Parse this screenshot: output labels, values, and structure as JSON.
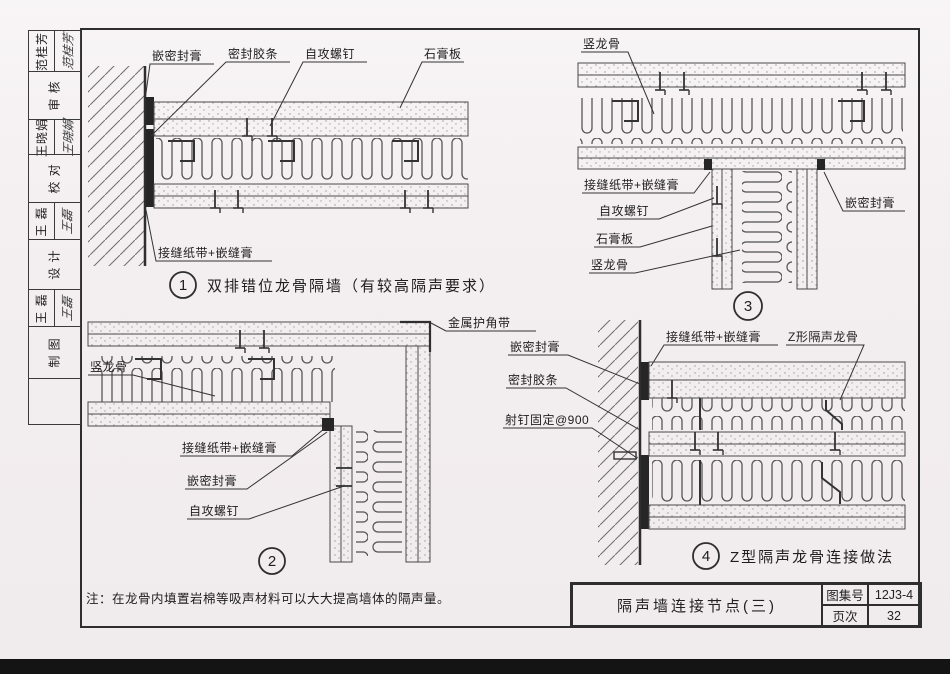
{
  "page": {
    "bg_color": "#f3eef0",
    "frame_color": "#2e2e2e",
    "line_color": "#3a3a3a"
  },
  "sidebar": {
    "groups": [
      {
        "role": "审 核",
        "name": "范桂芳",
        "signature": "范桂芳"
      },
      {
        "role": "校 对",
        "name": "王晓娟",
        "signature": "王晓娟"
      },
      {
        "role": "设 计",
        "name": "王 磊",
        "signature": "王磊"
      },
      {
        "role": "制 图",
        "name": "王 磊",
        "signature": "王磊"
      }
    ]
  },
  "drawings": {
    "d1": {
      "number": "1",
      "caption": "双排错位龙骨隔墙（有较高隔声要求）",
      "labels": {
        "seal": "嵌密封膏",
        "gasket": "密封胶条",
        "screw": "自攻螺钉",
        "board": "石膏板",
        "tape": "接缝纸带+嵌缝膏"
      }
    },
    "d2": {
      "number": "2",
      "labels": {
        "stud": "竖龙骨",
        "corner": "金属护角带",
        "tape": "接缝纸带+嵌缝膏",
        "seal": "嵌密封膏",
        "screw": "自攻螺钉"
      }
    },
    "d3": {
      "number": "3",
      "labels": {
        "stud_top": "竖龙骨",
        "tape": "接缝纸带+嵌缝膏",
        "screw": "自攻螺钉",
        "board": "石膏板",
        "stud": "竖龙骨",
        "seal": "嵌密封膏"
      }
    },
    "d4": {
      "number": "4",
      "caption": "Z型隔声龙骨连接做法",
      "labels": {
        "seal": "嵌密封膏",
        "gasket": "密封胶条",
        "nail": "射钉固定@900",
        "tape": "接缝纸带+嵌缝膏",
        "zstud": "Z形隔声龙骨"
      }
    }
  },
  "note": {
    "text": "注：在龙骨内填置岩棉等吸声材料可以大大提高墙体的隔声量。"
  },
  "title_block": {
    "title": "隔声墙连接节点(三)",
    "atlas_label": "图集号",
    "atlas_no": "12J3-4",
    "page_label": "页次",
    "page_no": "32"
  }
}
